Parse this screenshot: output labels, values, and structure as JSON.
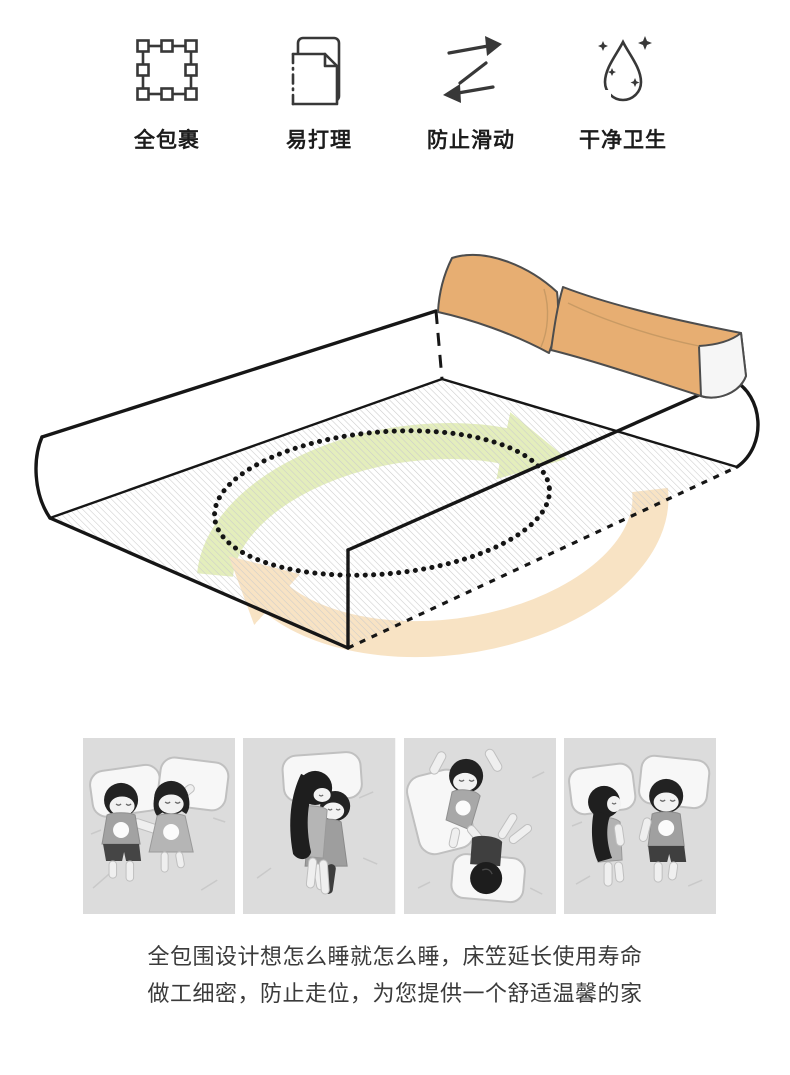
{
  "features": [
    {
      "label": "全包裹",
      "icon": "selection-square-icon"
    },
    {
      "label": "易打理",
      "icon": "document-sheet-icon"
    },
    {
      "label": "防止滑动",
      "icon": "swap-arrows-icon"
    },
    {
      "label": "干净卫生",
      "icon": "droplet-sparkles-icon"
    }
  ],
  "bed_diagram": {
    "name": "fitted-sheet-mattress-rotation-diagram",
    "colors": {
      "pillow": "#e7ae72",
      "pillow_end": "#f6f6f6",
      "arrow_green": "#e4eebc",
      "arrow_orange": "#f8e3c4",
      "outline": "#161616",
      "hatch": "#cbcbcb"
    }
  },
  "panels": [
    {
      "name": "sleep-pose-1",
      "background": "#dcdcdc"
    },
    {
      "name": "sleep-pose-2",
      "background": "#dcdcdc"
    },
    {
      "name": "sleep-pose-3",
      "background": "#dcdcdc"
    },
    {
      "name": "sleep-pose-4",
      "background": "#dcdcdc"
    }
  ],
  "caption": {
    "line1": "全包围设计想怎么睡就怎么睡，床笠延长使用寿命",
    "line2": "做工细密，防止走位，为您提供一个舒适温馨的家"
  }
}
